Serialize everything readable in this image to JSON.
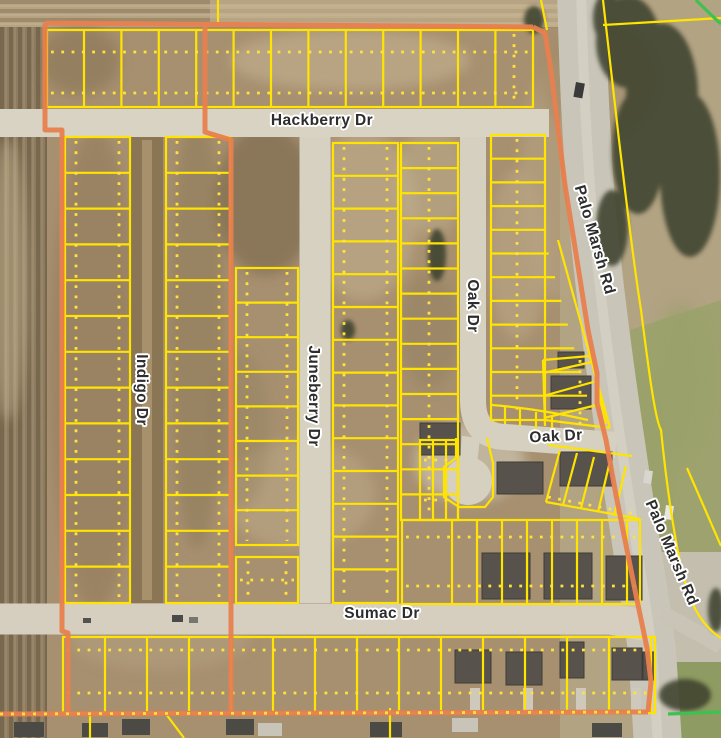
{
  "map": {
    "type": "aerial-parcel-map",
    "labels": {
      "hackberry": "Hackberry Dr",
      "indigo": "Indigo Dr",
      "juneberry": "Juneberry Dr",
      "oak_vertical": "Oak Dr",
      "oak_horizontal": "Oak Dr",
      "sumac": "Sumac Dr",
      "palo_marsh_upper": "Palo Marsh Rd",
      "palo_marsh_lower": "Palo Marsh Rd"
    },
    "colors": {
      "parcel_line": "#FFE400",
      "parcel_dot": "#FFE23C",
      "boundary_line": "#E87F4E",
      "trail_line": "#3DC24F",
      "road_fill": "#D6D0C0",
      "dirt_road_fill": "#8A7555",
      "label_text": "#2D2D2D",
      "label_halo": "#FFFFFF"
    }
  }
}
